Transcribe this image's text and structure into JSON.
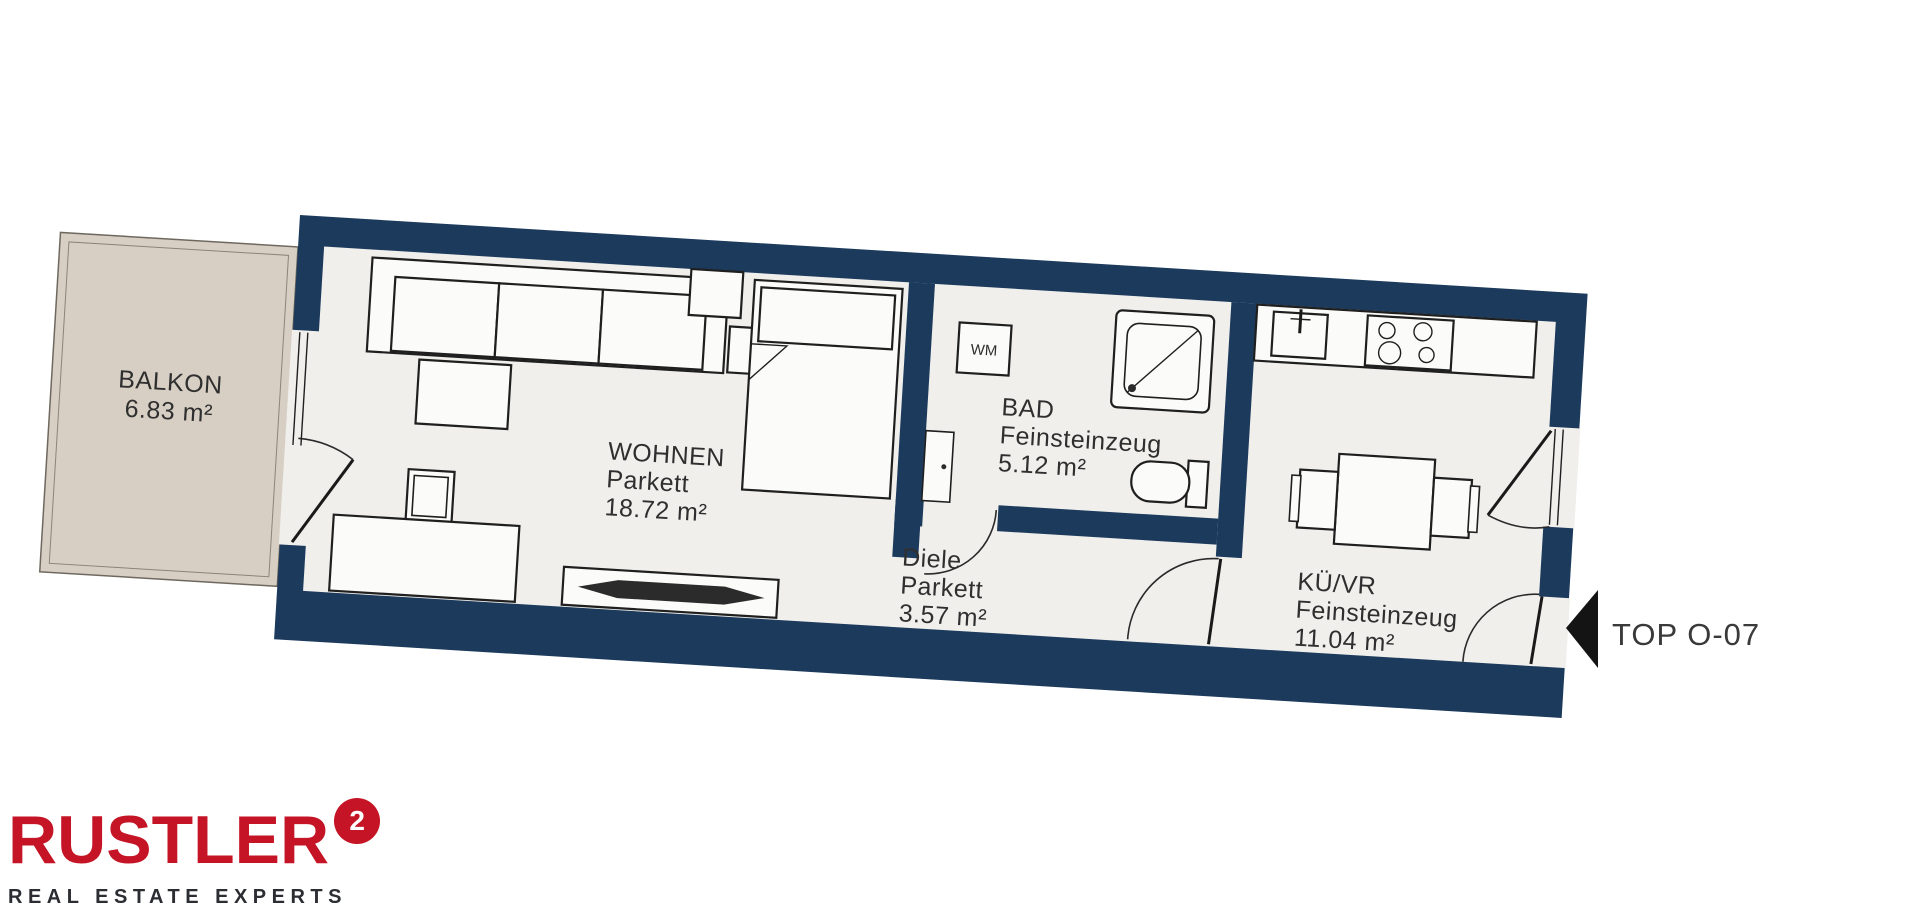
{
  "plan": {
    "unit": {
      "label": "TOP O-07"
    },
    "rooms": {
      "balkon": {
        "name": "BALKON",
        "area": "6.83 m²"
      },
      "wohnen": {
        "name": "WOHNEN",
        "floor": "Parkett",
        "area": "18.72 m²"
      },
      "bad": {
        "name": "BAD",
        "floor": "Feinsteinzeug",
        "area": "5.12 m²"
      },
      "diele": {
        "name": "Diele",
        "floor": "Parkett",
        "area": "3.57 m²"
      },
      "kueche": {
        "name": "KÜ/VR",
        "floor": "Feinsteinzeug",
        "area": "11.04 m²"
      }
    },
    "appliances": {
      "washing_machine": "WM"
    },
    "colors": {
      "wall": "#1c3a5c",
      "floor": "#f0efec",
      "balcony": "#d7cfc4",
      "furniture_outline": "#1f1f1f",
      "label_text": "#2f2f2f",
      "arrow": "#141414"
    }
  },
  "logo": {
    "brand": "RUSTLER",
    "superscript": "2",
    "tagline": "REAL ESTATE EXPERTS",
    "brand_color": "#c41425",
    "tagline_color": "#2b2d33"
  }
}
